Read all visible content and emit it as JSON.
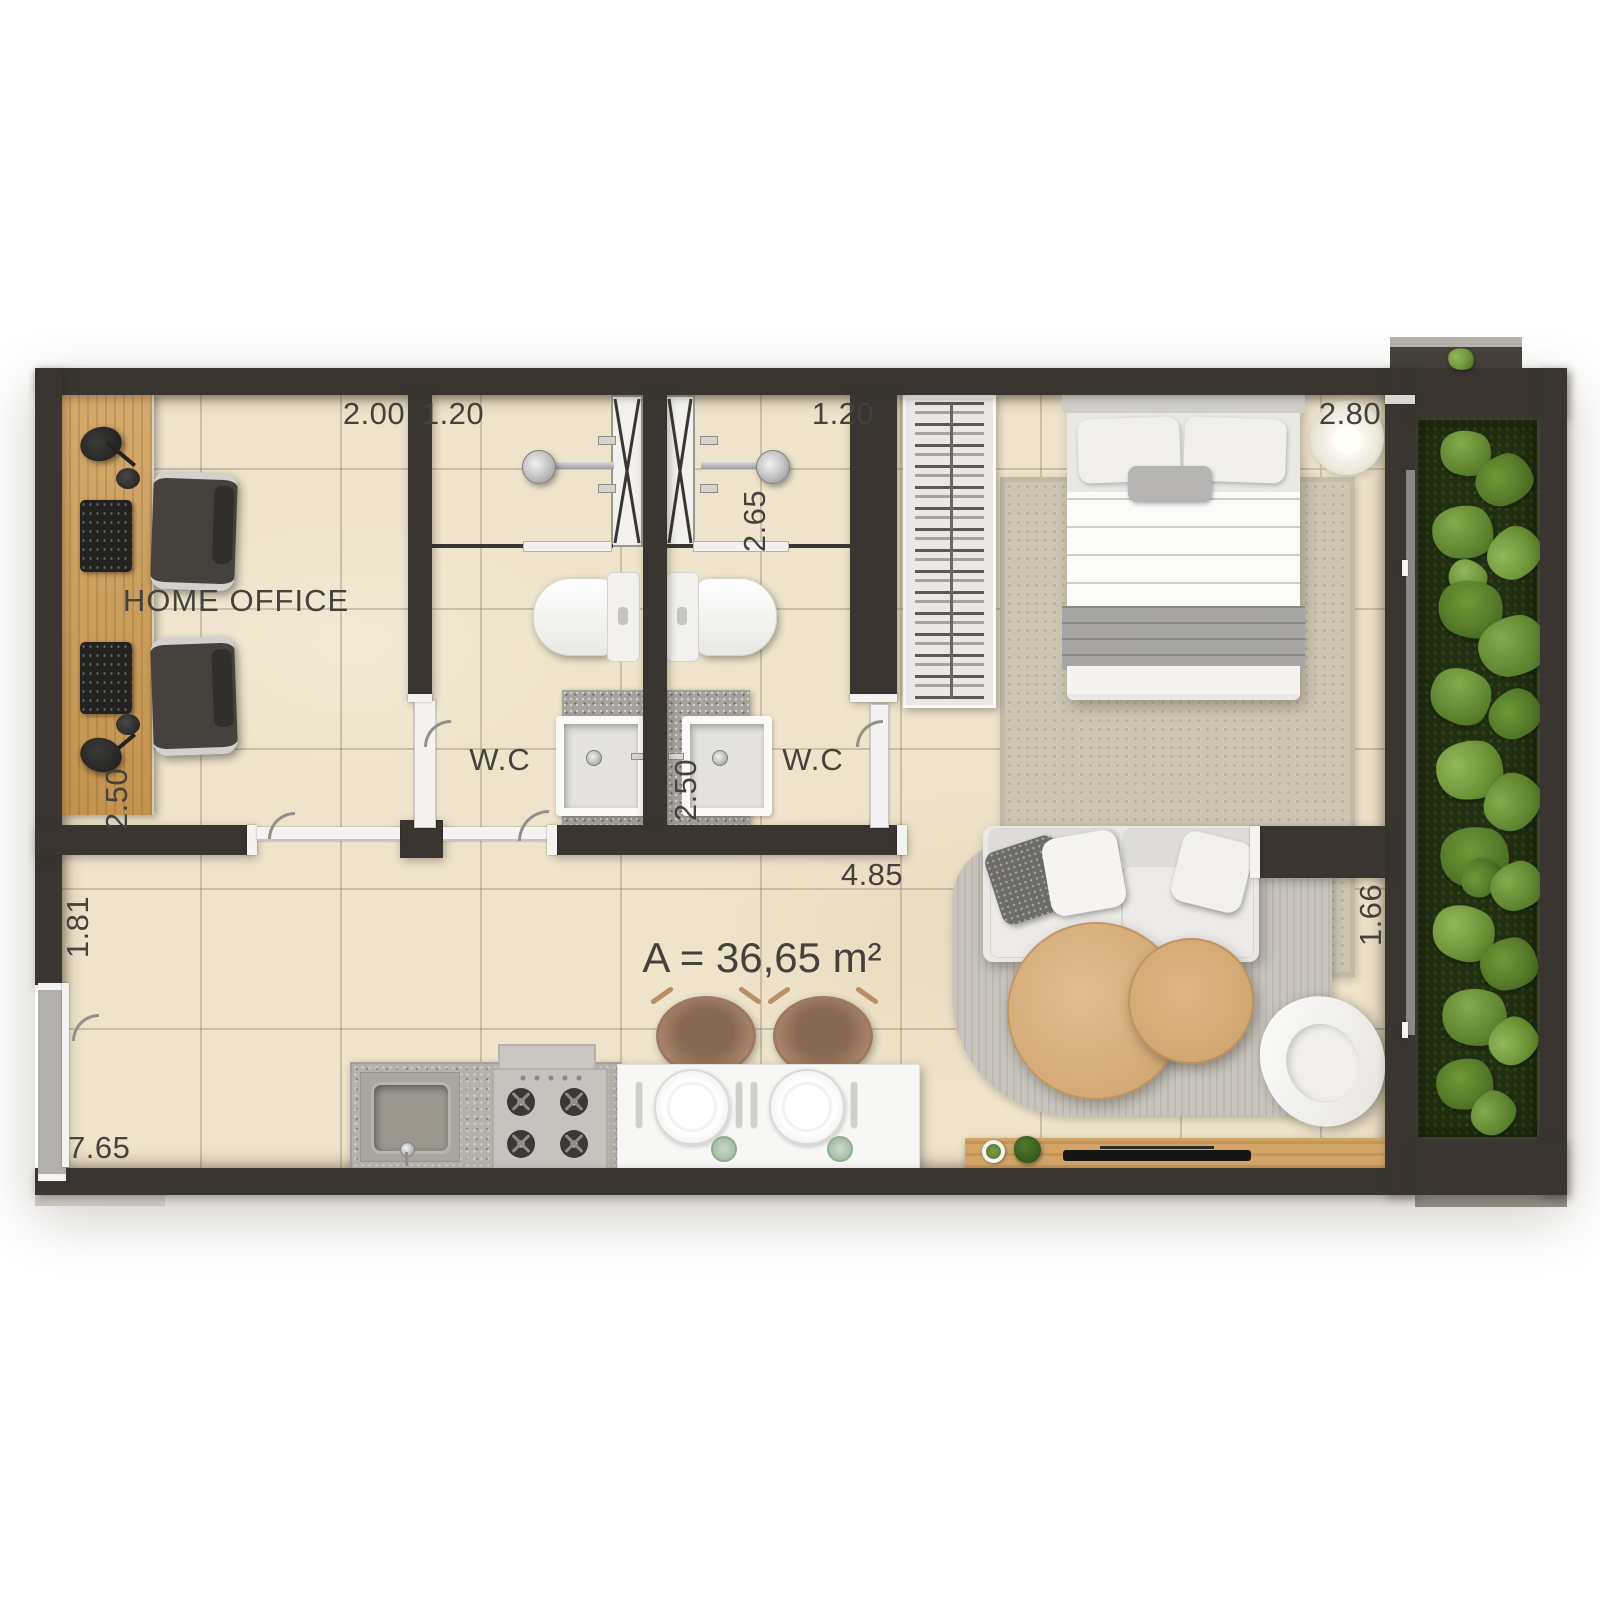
{
  "labels": {
    "home_office": "HOME OFFICE",
    "wc_left": "W.C",
    "wc_right": "W.C",
    "area": "A = 36,65 m²"
  },
  "dimensions": {
    "home_office_width": "2.00",
    "wc_left_width": "1.20",
    "wc_right_width": "1.20",
    "bedroom_width": "2.80",
    "wc_right_depth": "2.65",
    "home_office_depth": "2.50",
    "wc_right_lower_width": "2.50",
    "kitchen_hall_width": "1.81",
    "apartment_length": "7.65",
    "living_kitchen_length": "4.85",
    "balcony_door_width": "1.66"
  },
  "colors": {
    "wall": "#3a3531",
    "floor_tile": "#eee4cb",
    "desk_wood": "#cd9f61",
    "table_wood": "#ddb184",
    "garden_bed": "#212e11",
    "garden_leaf": "#5f8430",
    "bedroom_rug": "#cdc4b2",
    "living_rug": "#c5c1ba",
    "counter_granite": "#b5b2ac",
    "island_white": "#f7f7f6",
    "label_text": "#45413d"
  }
}
